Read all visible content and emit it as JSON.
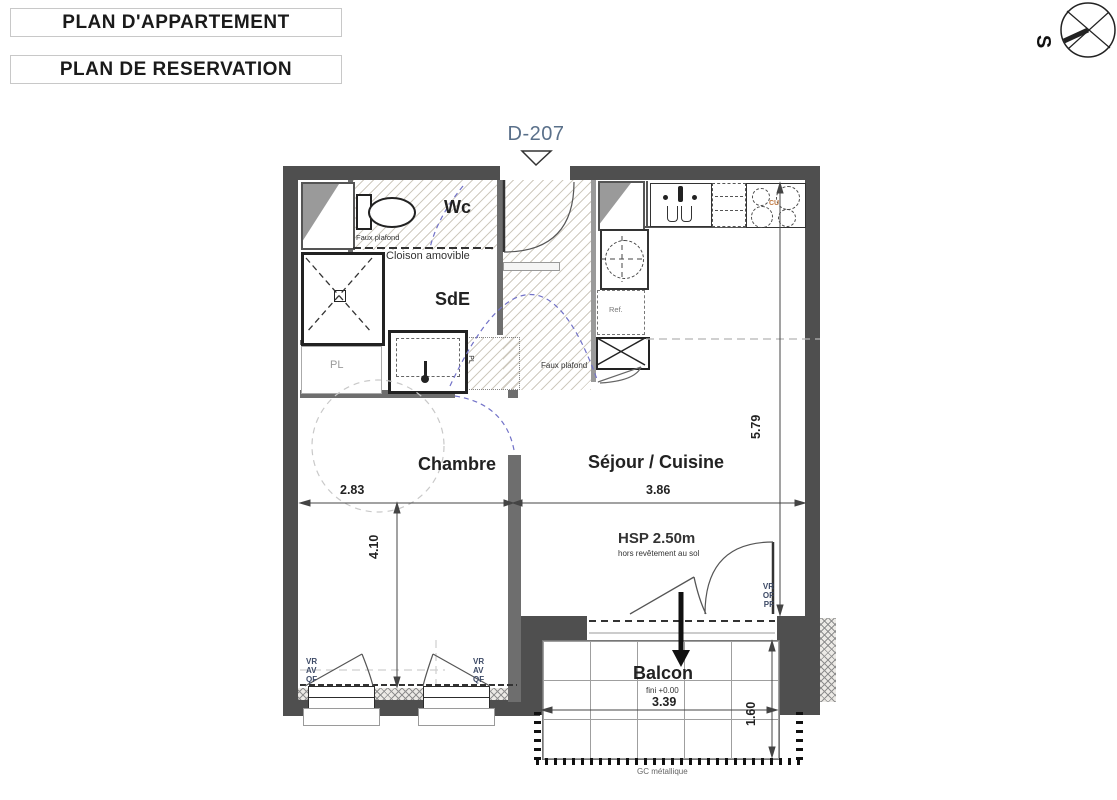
{
  "header": {
    "titles": [
      {
        "label": "PLAN D'APPARTEMENT"
      },
      {
        "label": "PLAN DE RESERVATION"
      }
    ]
  },
  "compass": {
    "label": "S"
  },
  "unit_marker": {
    "label": "D-207"
  },
  "rooms": {
    "wc": "Wc",
    "sde": "SdE",
    "chambre": "Chambre",
    "sejour": "Séjour / Cuisine",
    "balcon": "Balcon"
  },
  "annotations": {
    "faux_plafond_wc": "Faux plafond",
    "faux_plafond_sejour": "Faux plafond",
    "cloison_amovible": "Cloison amovible",
    "pl_closet": "PL",
    "pl_sde": "PL",
    "ref": "Ref.",
    "cu": "CU",
    "hsp": "HSP 2.50m",
    "hsp_note": "hors revêtement au sol",
    "fini": "fini +0.00",
    "gc": "GC métallique"
  },
  "window_tags": {
    "left": [
      "VR",
      "AV",
      "QF"
    ],
    "right": [
      "VR",
      "AV",
      "QF"
    ],
    "door": [
      "VR",
      "OF",
      "PF"
    ]
  },
  "dimensions": {
    "chambre_width": "2.83",
    "sejour_width": "3.86",
    "chambre_depth": "4.10",
    "sejour_depth": "5.79",
    "balcon_width": "3.39",
    "balcon_depth": "1.60"
  },
  "colors": {
    "wall": "#4f4f4f",
    "unit_label": "#5a708a",
    "tag": "#3d4a66",
    "cu": "#c07840"
  }
}
